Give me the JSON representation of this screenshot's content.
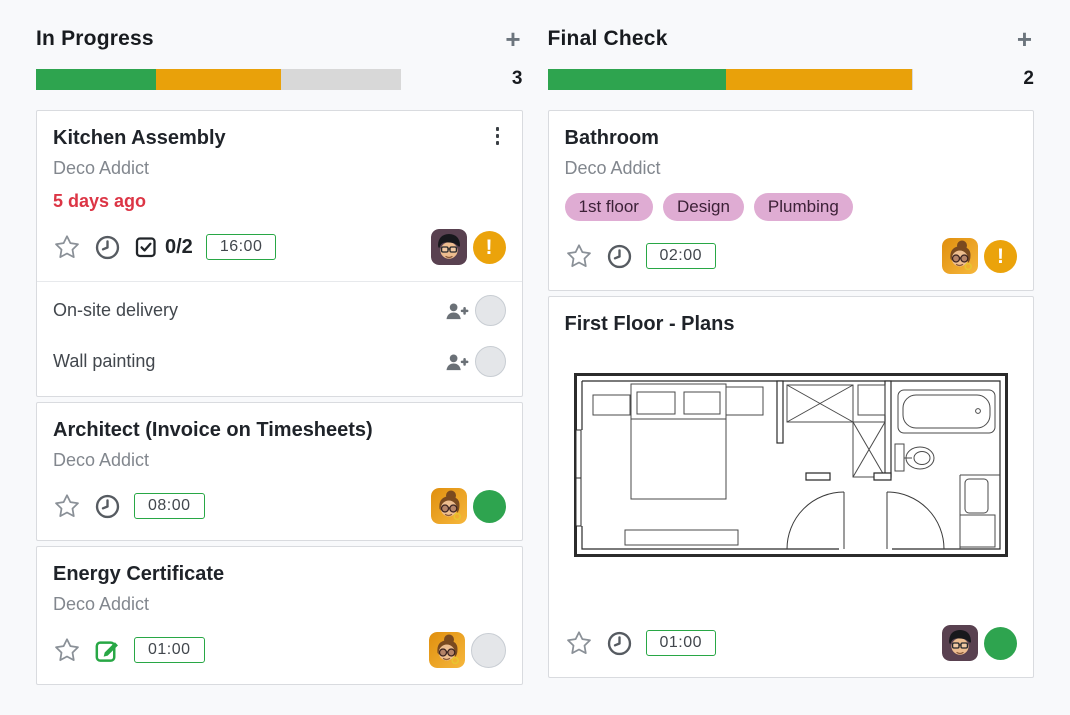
{
  "colors": {
    "progress_green": "#2ea44f",
    "progress_orange": "#e9a10a",
    "progress_remaining": "#d8d8d8",
    "badge_border_green": "#28a745",
    "late_red": "#dc3545",
    "tag_bg": "#dfacd3",
    "tag_text": "#3c2137",
    "activity_warning": "#eba30b",
    "activity_done": "#2ea44f",
    "activity_none": "#e4e6e9",
    "page_bg": "#f8f9fb",
    "card_border": "#d9dbdf"
  },
  "board": {
    "columns": [
      {
        "title": "In Progress",
        "count": "3",
        "add_label": "+",
        "progress_segments": [
          {
            "label": "success",
            "color": "#2ea44f",
            "pct": 33
          },
          {
            "label": "warning",
            "color": "#e9a10a",
            "pct": 34
          }
        ],
        "cards": [
          {
            "title": "Kitchen Assembly",
            "customer": "Deco Addict",
            "deadline": "5 days ago",
            "checklist": "0/2",
            "allocated_hours": "16:00",
            "avatar": "man-with-glasses",
            "activity": "warning",
            "subtasks": [
              {
                "title": "On-site delivery"
              },
              {
                "title": "Wall painting"
              }
            ]
          },
          {
            "title": "Architect (Invoice on Timesheets)",
            "customer": "Deco Addict",
            "allocated_hours": "08:00",
            "avatar": "woman-with-glasses",
            "activity": "done"
          },
          {
            "title": "Energy Certificate",
            "customer": "Deco Addict",
            "allocated_hours": "01:00",
            "avatar": "woman-with-glasses",
            "activity": "none"
          }
        ]
      },
      {
        "title": "Final Check",
        "count": "2",
        "add_label": "+",
        "progress_segments": [
          {
            "label": "success",
            "color": "#2ea44f",
            "pct": 49
          },
          {
            "label": "warning",
            "color": "#e9a10a",
            "pct": 51
          }
        ],
        "cards": [
          {
            "title": "Bathroom",
            "customer": "Deco Addict",
            "tags": [
              "1st floor",
              "Design",
              "Plumbing"
            ],
            "allocated_hours": "02:00",
            "avatar": "woman-with-glasses",
            "activity": "warning"
          },
          {
            "title": "First Floor - Plans",
            "allocated_hours": "01:00",
            "avatar": "man-with-glasses",
            "activity": "done",
            "image": "floor-plan"
          }
        ]
      }
    ]
  }
}
